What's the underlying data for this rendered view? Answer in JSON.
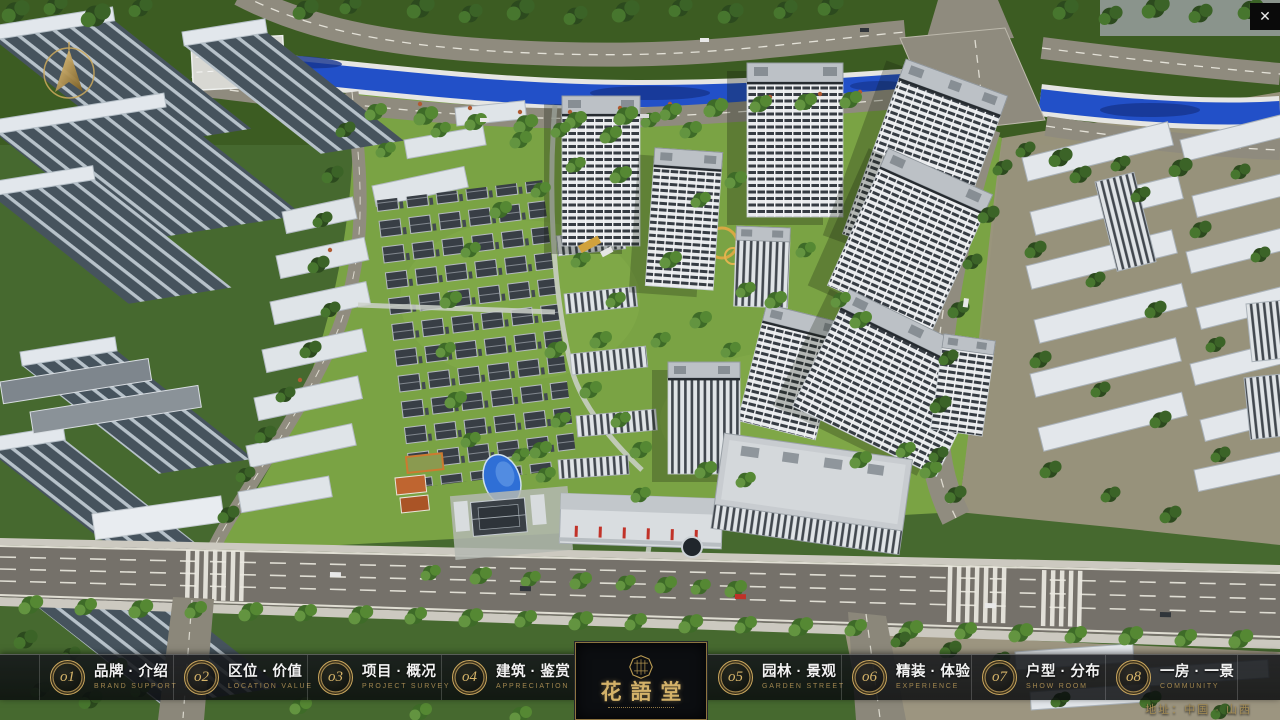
{
  "nav": {
    "items": [
      {
        "num": "o1",
        "zh": "品牌 · 介绍",
        "en": "BRAND SUPPORT"
      },
      {
        "num": "o2",
        "zh": "区位 · 价值",
        "en": "LOCATION VALUE"
      },
      {
        "num": "o3",
        "zh": "项目 · 概况",
        "en": "PROJECT SURVEY"
      },
      {
        "num": "o4",
        "zh": "建筑 · 鉴赏",
        "en": "APPRECIATION"
      },
      {
        "num": "o5",
        "zh": "园林 · 景观",
        "en": "GARDEN STREET"
      },
      {
        "num": "o6",
        "zh": "精装 · 体验",
        "en": "EXPERIENCE"
      },
      {
        "num": "o7",
        "zh": "户型 · 分布",
        "en": "SHOW ROOM"
      },
      {
        "num": "o8",
        "zh": "一房 · 一景",
        "en": "COMMUNITY"
      }
    ]
  },
  "logo": {
    "title": "花語堂"
  },
  "footer": {
    "address": "地址：中国 · 山西"
  },
  "icons": {
    "close": "✕"
  },
  "colors": {
    "gold": "#c8a75f",
    "nav_bg": "#0b0d10",
    "river": "#2250c8",
    "lawn": "#7aa344",
    "road": "#8d897c",
    "tree_dark": "#2c4a1e"
  }
}
